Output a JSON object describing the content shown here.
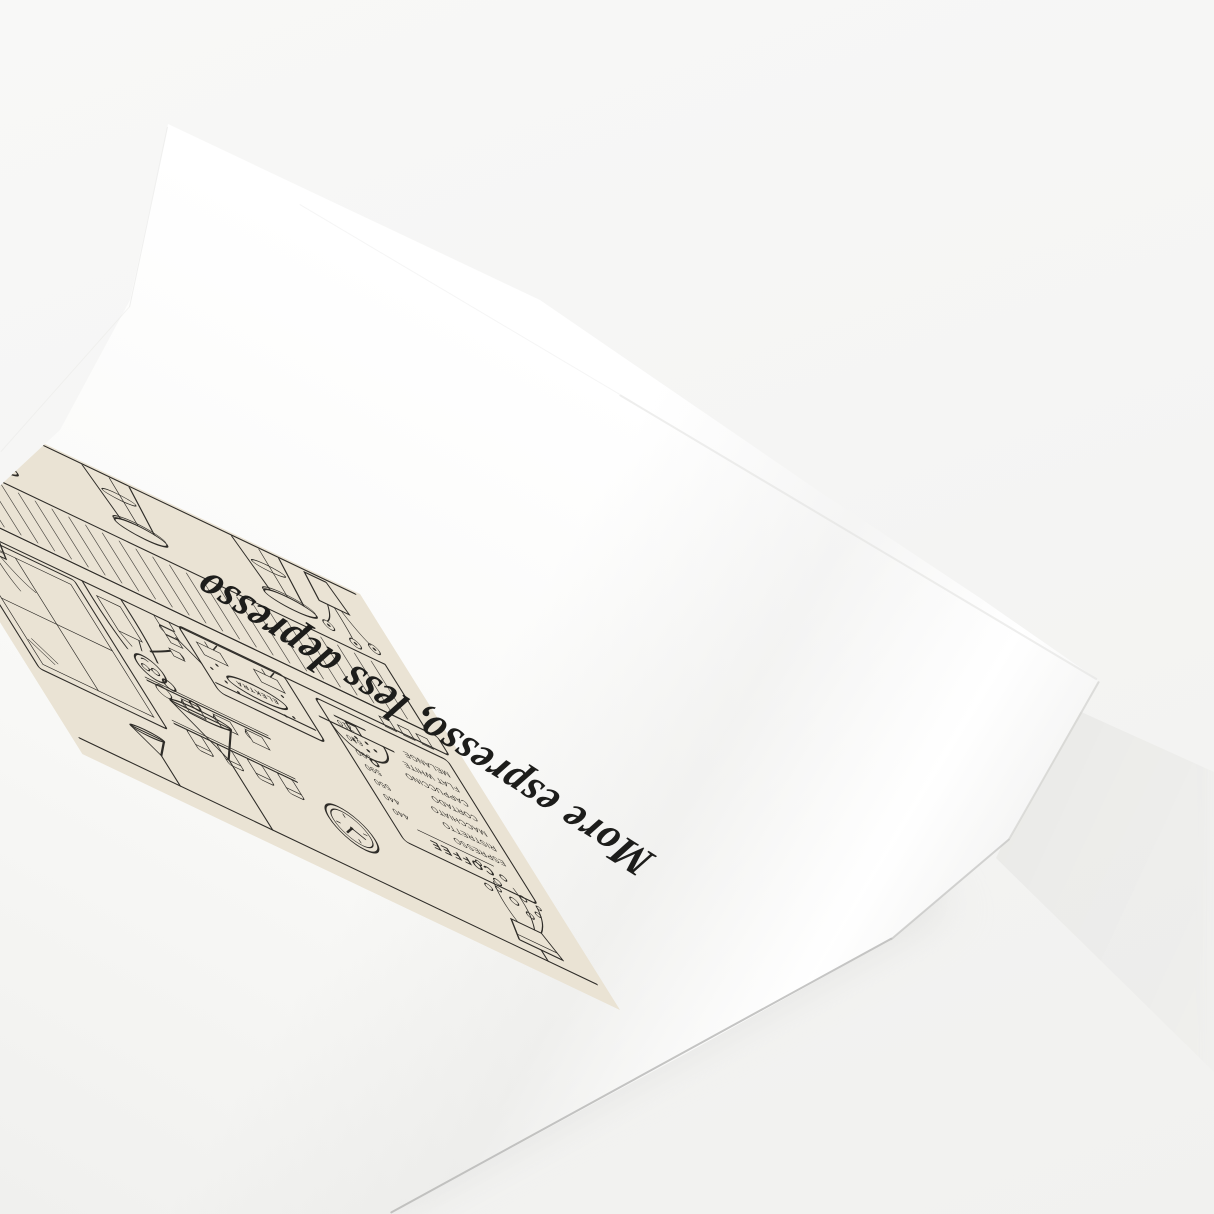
{
  "scene": {
    "backdrop_color": "#F5F5F3"
  },
  "poster": {
    "paper_color": "#FFFFFF",
    "script_title": "More espresso, less depresso",
    "artwork": {
      "background_color": "#EAE3D4",
      "ink_color": "#2E2C28",
      "machine_brand": "ELEKTRA",
      "menu": {
        "header": "COFFEE",
        "items": [
          {
            "name": "ESPRESSO",
            "price": "440"
          },
          {
            "name": "RISTRETTO",
            "price": "440"
          },
          {
            "name": "MACCHIATO",
            "price": "550"
          },
          {
            "name": "CORTADO",
            "price": "590"
          },
          {
            "name": "CAPPUCCINO",
            "price": "590"
          },
          {
            "name": "FLAT WHITE",
            "price": "610"
          },
          {
            "name": "MELANGE",
            "price": "710"
          }
        ]
      }
    }
  }
}
